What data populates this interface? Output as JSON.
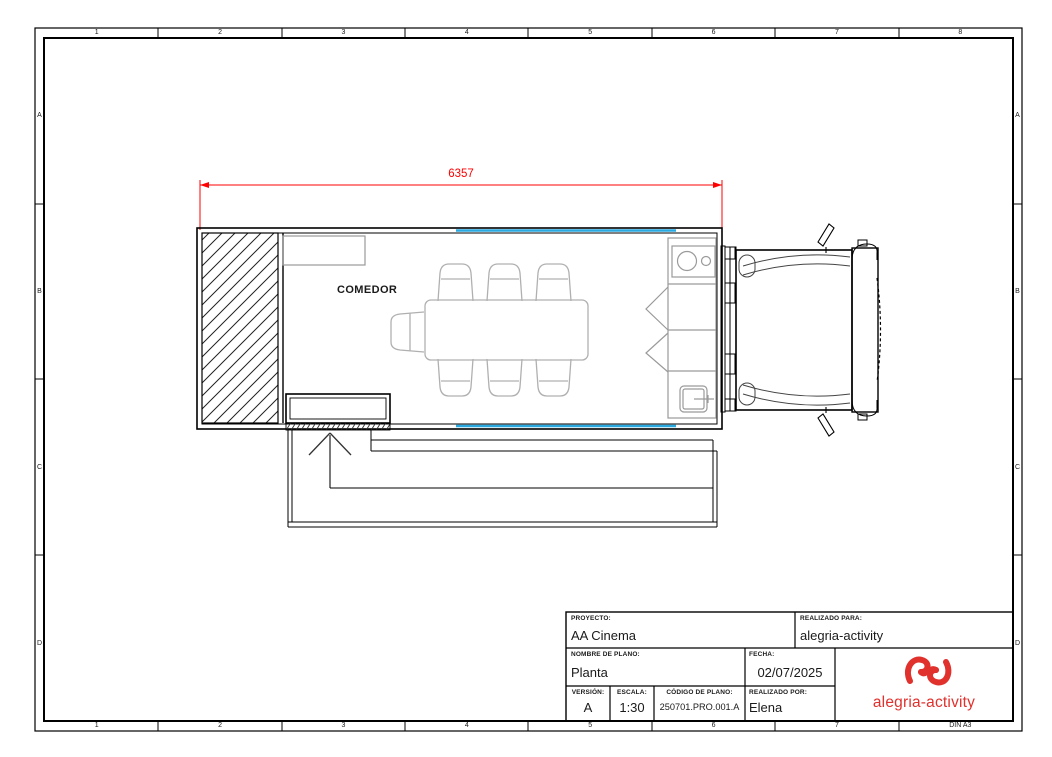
{
  "sheet": {
    "format": "DIN A3",
    "columns": [
      "1",
      "2",
      "3",
      "4",
      "5",
      "6",
      "7",
      "8"
    ],
    "rows": [
      "A",
      "B",
      "C",
      "D"
    ]
  },
  "plan": {
    "room_label": "COMEDOR",
    "overall_width_dimension": "6357",
    "dimension_color": "#ff0000",
    "awning_color": "#29a9df",
    "furniture_line_color": "#b0b0b0"
  },
  "title_block": {
    "proyecto_label": "PROYECTO:",
    "proyecto_value": "AA Cinema",
    "realizado_para_label": "REALIZADO PARA:",
    "realizado_para_value": "alegria-activity",
    "nombre_label": "NOMBRE DE PLANO:",
    "nombre_value": "Planta",
    "fecha_label": "FECHA:",
    "fecha_value": "02/07/2025",
    "version_label": "VERSIÓN:",
    "version_value": "A",
    "escala_label": "ESCALA:",
    "escala_value": "1:30",
    "codigo_label": "CÓDIGO DE PLANO:",
    "codigo_value": "250701.PRO.001.A",
    "realizado_por_label": "REALIZADO POR:",
    "realizado_por_value": "Elena",
    "logo_text": "alegria-activity",
    "logo_color": "#e0312d"
  }
}
